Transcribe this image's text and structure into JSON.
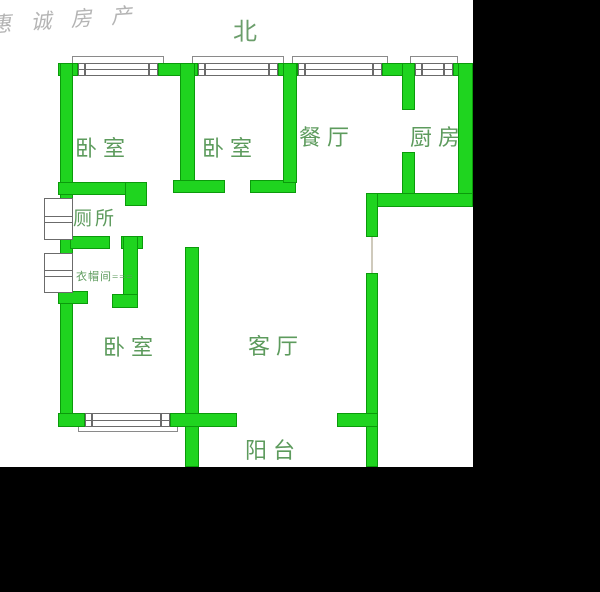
{
  "colors": {
    "wall_fill": "#1fd41f",
    "wall_border": "#0b9a0b",
    "label": "#5d9b5d",
    "north": "#6b9e6b",
    "watermark": "#a8a8a8",
    "window_line": "#6b6b6b",
    "letterbox": "#000000",
    "background": "#ffffff"
  },
  "watermark": {
    "text": "惠 诚 房 产"
  },
  "compass": {
    "label": "北"
  },
  "rooms": [
    {
      "id": "bedroom-1",
      "label": "卧室"
    },
    {
      "id": "bedroom-2",
      "label": "卧室"
    },
    {
      "id": "dining",
      "label": "餐厅"
    },
    {
      "id": "kitchen",
      "label": "厨房"
    },
    {
      "id": "toilet",
      "label": "厕所"
    },
    {
      "id": "cloakroom",
      "label": "衣帽间==="
    },
    {
      "id": "bedroom-3",
      "label": "卧室"
    },
    {
      "id": "living",
      "label": "客厅"
    },
    {
      "id": "balcony",
      "label": "阳台"
    }
  ]
}
